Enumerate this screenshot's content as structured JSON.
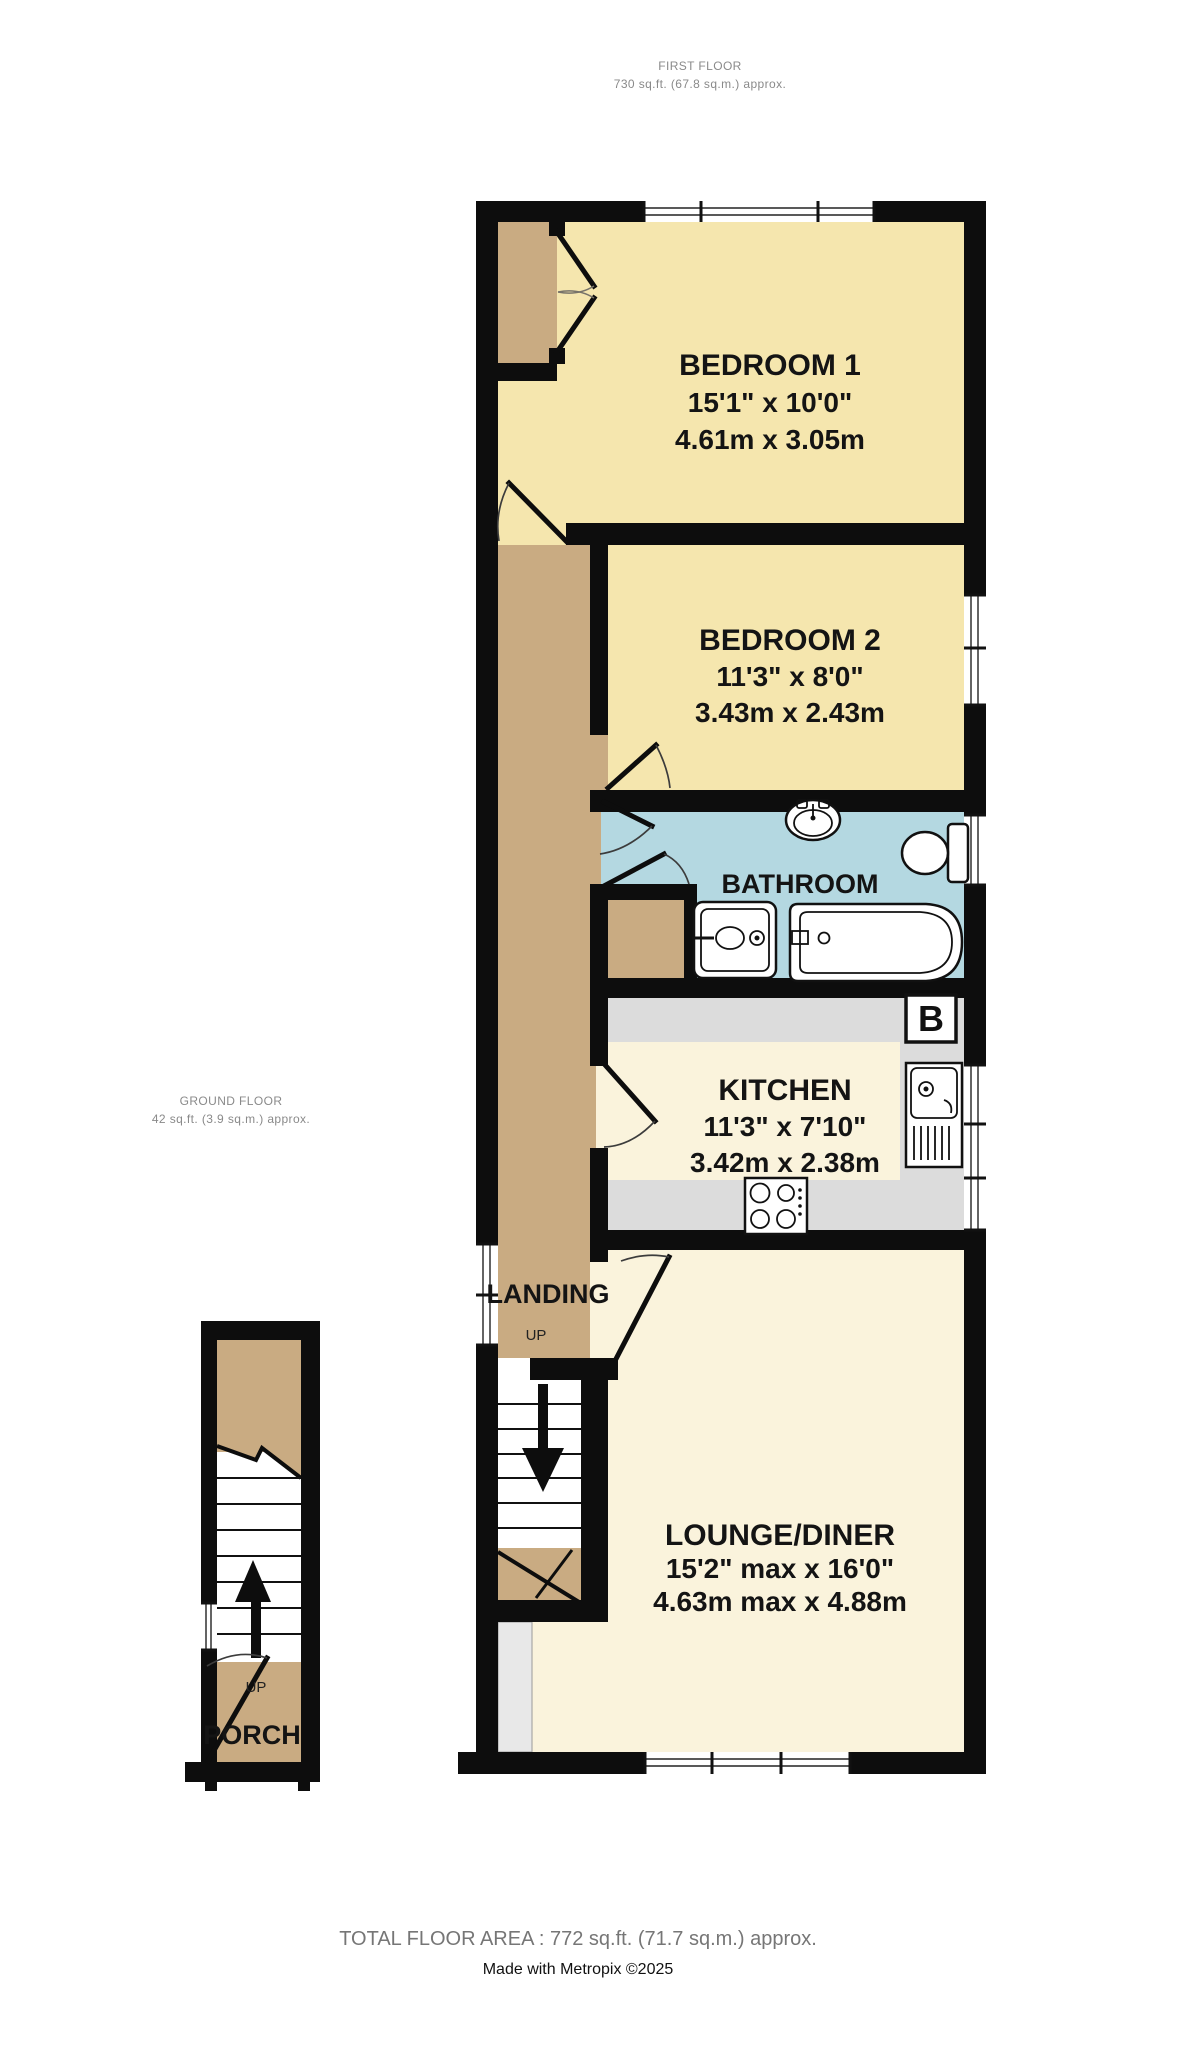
{
  "header": {
    "floor": "FIRST FLOOR",
    "area": "730 sq.ft. (67.8 sq.m.) approx."
  },
  "ground": {
    "floor": "GROUND FLOOR",
    "area": "42 sq.ft. (3.9 sq.m.) approx."
  },
  "rooms": {
    "bedroom1": {
      "name": "BEDROOM 1",
      "imperial": "15'1\" x 10'0\"",
      "metric": "4.61m x 3.05m"
    },
    "bedroom2": {
      "name": "BEDROOM 2",
      "imperial": "11'3\" x 8'0\"",
      "metric": "3.43m x 2.43m"
    },
    "bathroom": {
      "name": "BATHROOM"
    },
    "kitchen": {
      "name": "KITCHEN",
      "imperial": "11'3\" x 7'10\"",
      "metric": "3.42m x 2.38m"
    },
    "lounge": {
      "name": "LOUNGE/DINER",
      "imperial": "15'2\" max x 16'0\"",
      "metric": "4.63m max x 4.88m"
    },
    "landing": {
      "name": "LANDING",
      "up": "UP"
    },
    "porch": {
      "name": "PORCH",
      "up": "UP"
    }
  },
  "annotations": {
    "boiler": "B"
  },
  "footer": {
    "total": "TOTAL FLOOR AREA : 772 sq.ft. (71.7 sq.m.) approx.",
    "credit": "Made with Metropix ©2025"
  },
  "colors": {
    "wall": "#0d0d0d",
    "room_yellow": "#f5e6ae",
    "room_cream": "#faf3dc",
    "bathroom_blue": "#b4d8e1",
    "tan": "#c9ab82",
    "counter_gray": "#dcdcdc",
    "recess_gray": "#e8e8e8",
    "caption_gray": "#8a8a8a"
  }
}
